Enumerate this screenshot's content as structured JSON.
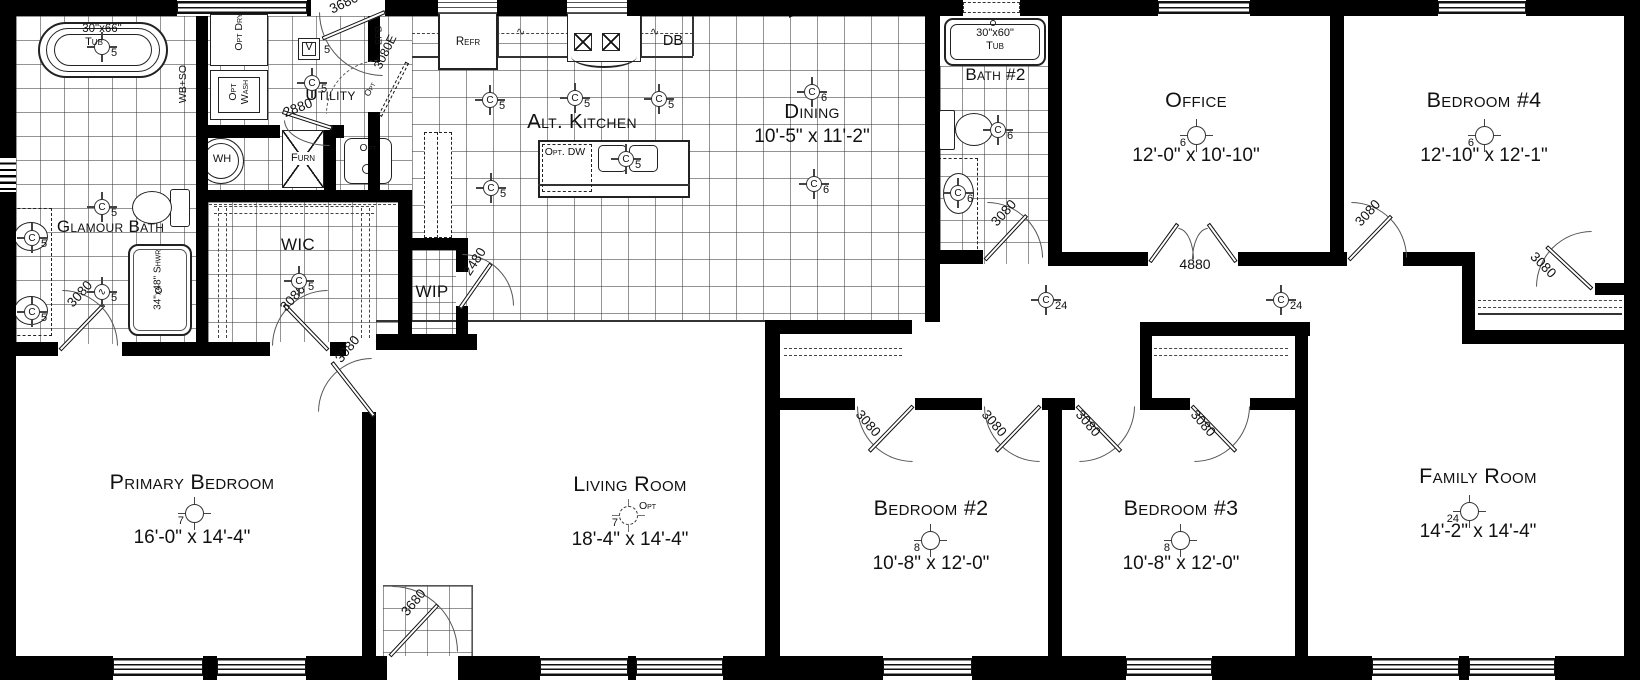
{
  "title": "Single-story floor plan",
  "rooms": [
    {
      "id": "primary",
      "name": "Primary Bedroom",
      "dims": "16'-0\" x 14'-4\""
    },
    {
      "id": "living",
      "name": "Living Room",
      "dims": "18'-4\" x 14'-4\""
    },
    {
      "id": "bed2",
      "name": "Bedroom #2",
      "dims": "10'-8\" x 12'-0\""
    },
    {
      "id": "bed3",
      "name": "Bedroom #3",
      "dims": "10'-8\" x 12'-0\""
    },
    {
      "id": "family",
      "name": "Family Room",
      "dims": "14'-2\" x 14'-4\""
    },
    {
      "id": "office",
      "name": "Office",
      "dims": "12'-0\" x 10'-10\""
    },
    {
      "id": "bed4",
      "name": "Bedroom #4",
      "dims": "12'-10\" x 12'-1\""
    },
    {
      "id": "dining",
      "name": "Dining",
      "dims": "10'-5\" x 11'-2\""
    },
    {
      "id": "kitchen",
      "name": "Alt. Kitchen",
      "dims": ""
    },
    {
      "id": "glamour",
      "name": "Glamour Bath",
      "dims": ""
    },
    {
      "id": "bath2",
      "name": "Bath #2",
      "dims": ""
    },
    {
      "id": "utility",
      "name": "Utility",
      "dims": ""
    },
    {
      "id": "wic",
      "name": "WIC",
      "dims": ""
    },
    {
      "id": "wip",
      "name": "WIP",
      "dims": ""
    }
  ],
  "doors": [
    {
      "id": "utility3680",
      "label": "3680"
    },
    {
      "id": "utility2880",
      "label": "2880"
    },
    {
      "id": "opt3080e",
      "label": "3080E"
    },
    {
      "id": "wip2480",
      "label": "2480"
    },
    {
      "id": "glam3080",
      "label": "3080"
    },
    {
      "id": "wic3080",
      "label": "3080"
    },
    {
      "id": "primary3080",
      "label": "3080"
    },
    {
      "id": "entry3680",
      "label": "3680"
    },
    {
      "id": "bath23080",
      "label": "3080"
    },
    {
      "id": "office4880",
      "label": "4880"
    },
    {
      "id": "bed43080",
      "label": "3080"
    },
    {
      "id": "bed4closet3080",
      "label": "3080"
    },
    {
      "id": "bed2closet3080",
      "label": "3080"
    },
    {
      "id": "bed2entry3080",
      "label": "3080"
    },
    {
      "id": "bed3entry3080",
      "label": "3080"
    },
    {
      "id": "bed3closet3080",
      "label": "3080"
    }
  ],
  "symbols": [
    {
      "id": "tub1",
      "kind": "c",
      "letter": "",
      "num": "5"
    },
    {
      "id": "glamc1",
      "kind": "c",
      "letter": "C",
      "num": "5"
    },
    {
      "id": "glamfan",
      "kind": "c",
      "letter": "∿",
      "num": "5"
    },
    {
      "id": "sink1",
      "kind": "c",
      "letter": "C",
      "num": "5"
    },
    {
      "id": "sink2",
      "kind": "c",
      "letter": "C",
      "num": "5"
    },
    {
      "id": "utilc",
      "kind": "c",
      "letter": "C",
      "num": "5"
    },
    {
      "id": "wicc",
      "kind": "c",
      "letter": "C",
      "num": "5"
    },
    {
      "id": "kitc1",
      "kind": "c",
      "letter": "C",
      "num": "5"
    },
    {
      "id": "kitc2",
      "kind": "c",
      "letter": "C",
      "num": "5"
    },
    {
      "id": "kitc3",
      "kind": "c",
      "letter": "C",
      "num": "5"
    },
    {
      "id": "kitc4",
      "kind": "c",
      "letter": "C",
      "num": "5"
    },
    {
      "id": "islc",
      "kind": "c",
      "letter": "C",
      "num": "5"
    },
    {
      "id": "dinc1",
      "kind": "c",
      "letter": "C",
      "num": "6"
    },
    {
      "id": "dinc2",
      "kind": "c",
      "letter": "C",
      "num": "6"
    },
    {
      "id": "bath2c1",
      "kind": "c",
      "letter": "C",
      "num": "6"
    },
    {
      "id": "bath2c2",
      "kind": "c",
      "letter": "C",
      "num": "6"
    },
    {
      "id": "hallc1",
      "kind": "c",
      "letter": "C",
      "num": "24"
    },
    {
      "id": "hallc2",
      "kind": "c",
      "letter": "C",
      "num": "24"
    },
    {
      "id": "officefan",
      "kind": "fan",
      "letter": "",
      "num": "6"
    },
    {
      "id": "bed4fan",
      "kind": "fan",
      "letter": "",
      "num": "6"
    },
    {
      "id": "primaryfan",
      "kind": "fan",
      "letter": "",
      "num": "7"
    },
    {
      "id": "livingfan",
      "kind": "fan-dashed",
      "letter": "",
      "num": "7",
      "note": "Opt"
    },
    {
      "id": "bed2fan",
      "kind": "fan",
      "letter": "",
      "num": "8"
    },
    {
      "id": "bed3fan",
      "kind": "fan",
      "letter": "",
      "num": "8"
    },
    {
      "id": "familyfan",
      "kind": "fan",
      "letter": "",
      "num": "24"
    }
  ],
  "fixtures": [
    {
      "id": "tub1size",
      "text": "30\"x66\""
    },
    {
      "id": "tub1name",
      "text": "Tub"
    },
    {
      "id": "wbso",
      "text": "WB+SO"
    },
    {
      "id": "optdry",
      "text": "Opt Dry"
    },
    {
      "id": "optwash",
      "text": "Opt Wash"
    },
    {
      "id": "vbox",
      "text": "V"
    },
    {
      "id": "v5",
      "text": "5"
    },
    {
      "id": "epb",
      "text": "EPB"
    },
    {
      "id": "opte",
      "text": "Opt"
    },
    {
      "id": "wh",
      "text": "WH"
    },
    {
      "id": "furn",
      "text": "Furn"
    },
    {
      "id": "optsink",
      "text": "Opt"
    },
    {
      "id": "shwr",
      "text": "34\"x48\" Shwr"
    },
    {
      "id": "refr",
      "text": "Refr"
    },
    {
      "id": "db",
      "text": "DB"
    },
    {
      "id": "optdw",
      "text": "Opt. DW"
    },
    {
      "id": "tub2size",
      "text": "30\"x60\""
    },
    {
      "id": "tub2name",
      "text": "Tub"
    }
  ]
}
